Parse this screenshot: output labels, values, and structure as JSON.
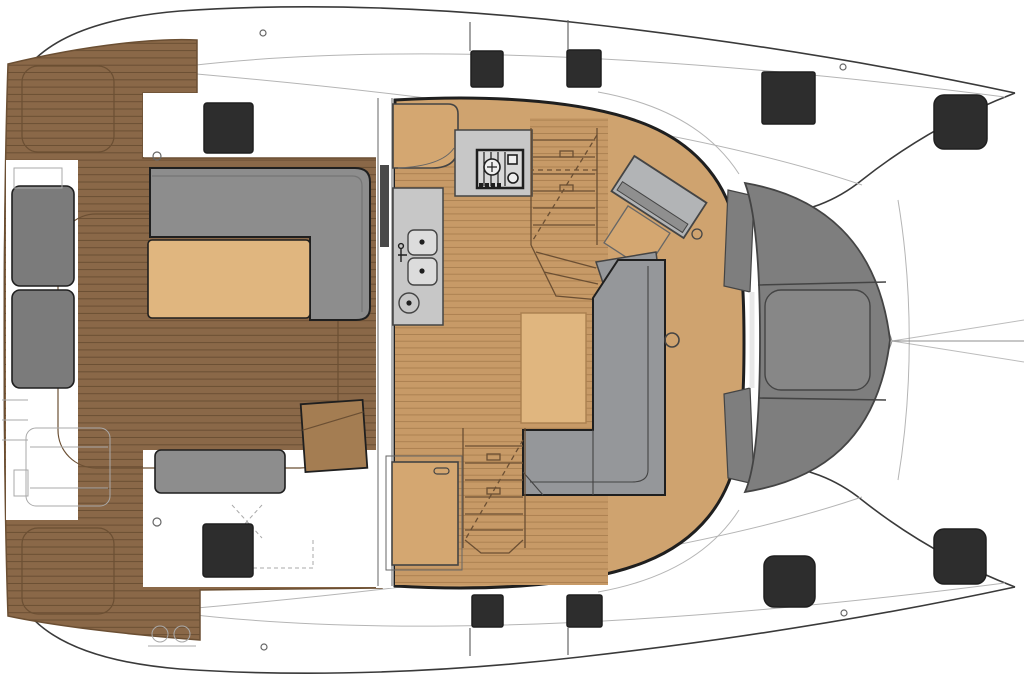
{
  "diagram": {
    "kind": "catamaran-deck-plan-top-view",
    "regions": {
      "aft_cockpit": "aft-cockpit-teak-deck",
      "salon": "salon-and-galley",
      "foredeck": "foredeck-and-trampoline",
      "forward_cockpit": "forward-cockpit-bench",
      "port_hull": "port-hull-deck",
      "starboard_hull": "starboard-hull-deck"
    }
  },
  "colors": {
    "white": "#ffffff",
    "outline": "#1f1f1f",
    "hull_line": "#3a3a3a",
    "faint": "#b5b5b5",
    "sketch": "#a9a9a9",
    "dash": "#8f8f8f",
    "teak": "#8a6848",
    "teak_line": "#6b4f33",
    "salon_wood": "#c79a67",
    "salon_wood_line": "#aa7f4f",
    "salon_smooth": "#cfa36f",
    "panel_tan": "#d4a771",
    "table_tan": "#e0b67f",
    "settee_gray": "#8d8d8d",
    "settee_dark": "#757575",
    "cushion_gray": "#7b7b7b",
    "dinette_gray": "#95979a",
    "band_gray": "#7e7e7e",
    "band_mid_gray": "#878787",
    "counter_gray": "#c7c7c7",
    "sink_gray": "#dcdcdc",
    "desk_gray": "#b2b4b6",
    "door_gray": "#4a4a4a",
    "hatch_black": "#2d2d2d",
    "stroke_mid": "#444444",
    "stroke_soft": "#666666"
  }
}
